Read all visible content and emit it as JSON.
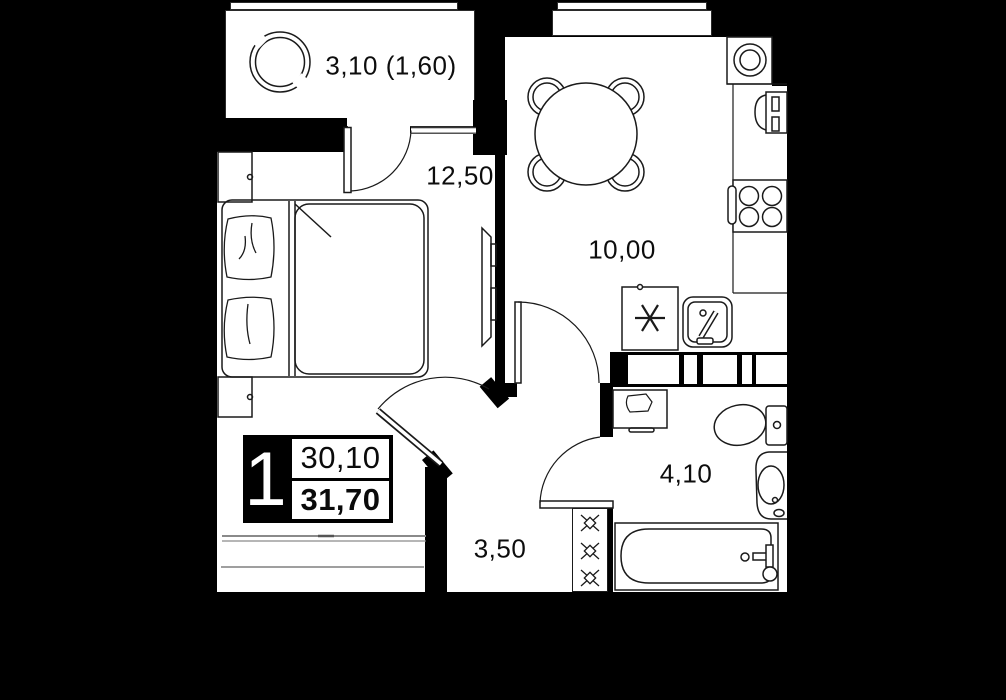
{
  "badge": {
    "room_count": "1",
    "area_top": "30,10",
    "area_bottom": "31,70"
  },
  "rooms": [
    {
      "name": "balcony",
      "area_label": "3,10 (1,60)"
    },
    {
      "name": "bedroom",
      "area_label": "12,50"
    },
    {
      "name": "kitchen-living",
      "area_label": "10,00"
    },
    {
      "name": "bathroom",
      "area_label": "4,10"
    },
    {
      "name": "hallway",
      "area_label": "3,50"
    }
  ],
  "colors": {
    "background": "#000000",
    "floor": "#ffffff",
    "line": "#1a1a1a"
  }
}
